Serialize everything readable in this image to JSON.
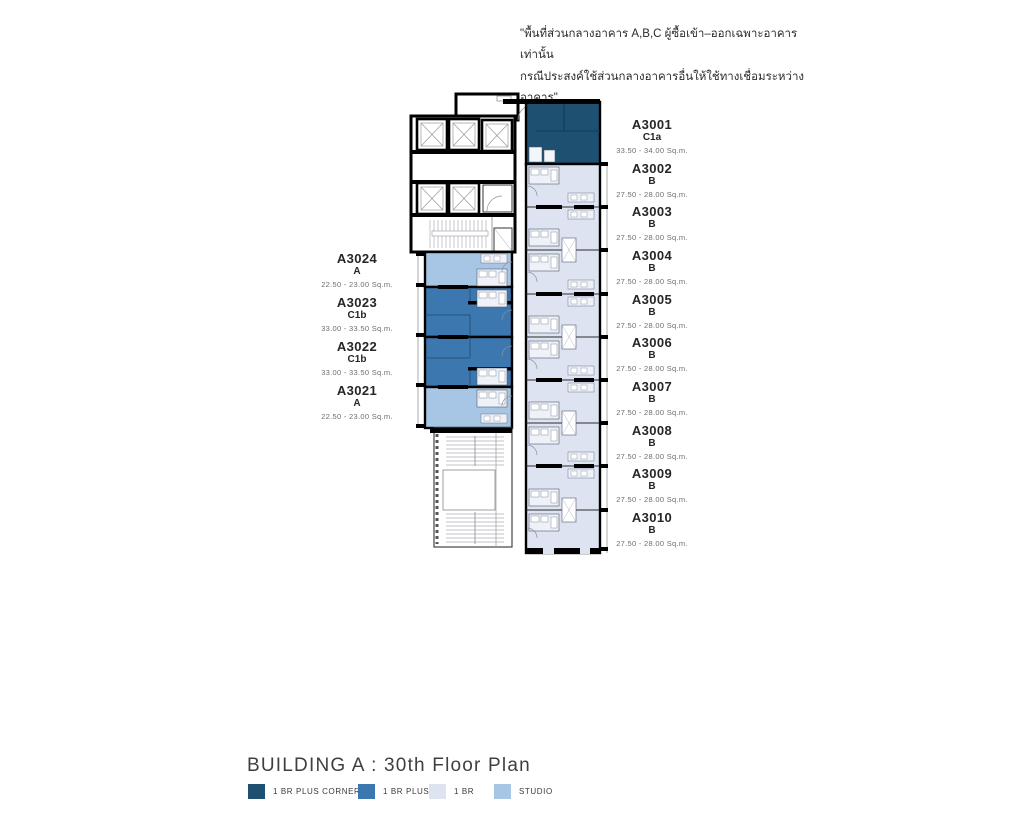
{
  "disclaimer": {
    "line1": "\"พื้นที่ส่วนกลางอาคาร A,B,C ผู้ซื้อเข้า–ออกเฉพาะอาคารเท่านั้น",
    "line2": "กรณีประสงค์ใช้ส่วนกลางอาคารอื่นให้ใช้ทางเชื่อมระหว่างอาคาร\""
  },
  "footer": {
    "title": "BUILDING A : 30th Floor Plan"
  },
  "legend": {
    "items": [
      {
        "label": "1 BR PLUS CORNER",
        "color": "#1e5071"
      },
      {
        "label": "1 BR PLUS",
        "color": "#3c77b0"
      },
      {
        "label": "1 BR",
        "color": "#dde3f1"
      },
      {
        "label": "STUDIO",
        "color": "#a7c5e4"
      }
    ]
  },
  "plan": {
    "left_units": [
      {
        "name": "A3024",
        "type": "A",
        "area": "22.50 - 23.00 Sq.m."
      },
      {
        "name": "A3023",
        "type": "C1b",
        "area": "33.00 - 33.50 Sq.m."
      },
      {
        "name": "A3022",
        "type": "C1b",
        "area": "33.00 - 33.50 Sq.m."
      },
      {
        "name": "A3021",
        "type": "A",
        "area": "22.50 - 23.00 Sq.m."
      }
    ],
    "right_units": [
      {
        "name": "A3001",
        "type": "C1a",
        "area": "33.50 - 34.00 Sq.m."
      },
      {
        "name": "A3002",
        "type": "B",
        "area": "27.50 - 28.00 Sq.m."
      },
      {
        "name": "A3003",
        "type": "B",
        "area": "27.50 - 28.00 Sq.m."
      },
      {
        "name": "A3004",
        "type": "B",
        "area": "27.50 - 28.00 Sq.m."
      },
      {
        "name": "A3005",
        "type": "B",
        "area": "27.50 - 28.00 Sq.m."
      },
      {
        "name": "A3006",
        "type": "B",
        "area": "27.50 - 28.00 Sq.m."
      },
      {
        "name": "A3007",
        "type": "B",
        "area": "27.50 - 28.00 Sq.m."
      },
      {
        "name": "A3008",
        "type": "B",
        "area": "27.50 - 28.00 Sq.m."
      },
      {
        "name": "A3009",
        "type": "B",
        "area": "27.50 - 28.00 Sq.m."
      },
      {
        "name": "A3010",
        "type": "B",
        "area": "27.50 - 28.00 Sq.m."
      }
    ]
  }
}
